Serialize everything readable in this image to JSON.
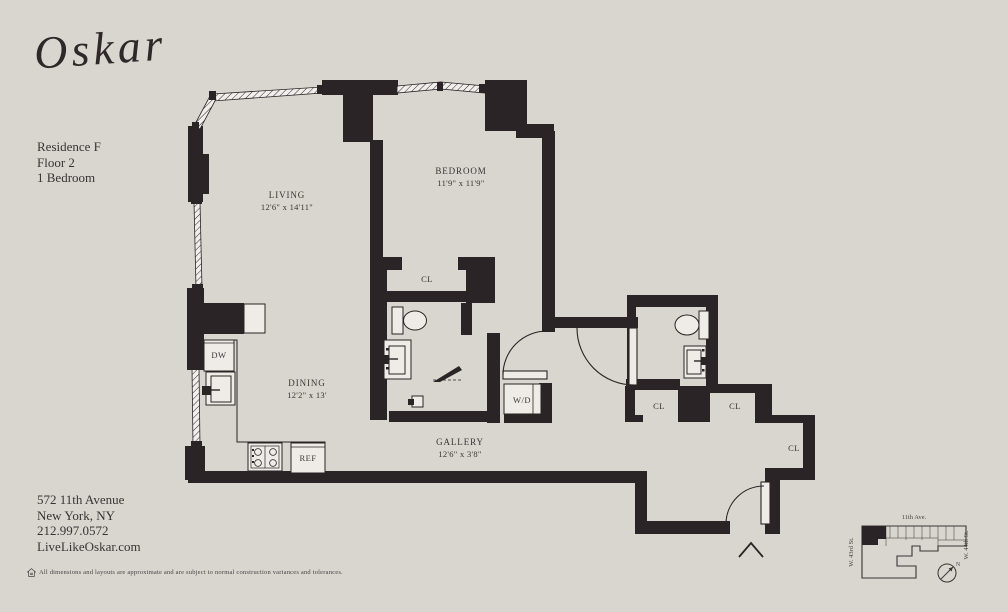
{
  "brand": {
    "logo": "Oskar"
  },
  "unit": {
    "residence": "Residence F",
    "floor": "Floor 2",
    "type": "1 Bedroom"
  },
  "contact": {
    "address": "572 11th Avenue",
    "city": "New York, NY",
    "phone": "212.997.0572",
    "website": "LiveLikeOskar.com"
  },
  "disclaimer": "All dimensions and layouts are approximate and are subject to normal construction variances and tolerances.",
  "rooms": {
    "living": {
      "name": "LIVING",
      "dims": "12'6\" x 14'11\""
    },
    "bedroom": {
      "name": "BEDROOM",
      "dims": "11'9\" x 11'9\""
    },
    "dining": {
      "name": "DINING",
      "dims": "12'2\" x 13'"
    },
    "gallery": {
      "name": "GALLERY",
      "dims": "12'6\" x 3'8\""
    }
  },
  "fixtures": {
    "closet": "CL",
    "dishwasher": "DW",
    "refrigerator": "REF",
    "washer_dryer": "W/D"
  },
  "keyplan": {
    "avenue": "11th Ave.",
    "street_left": "W. 43rd St.",
    "street_right": "W. 44th St.",
    "north": "N"
  },
  "colors": {
    "background": "#d9d5cf",
    "wall": "#2a2426",
    "text": "#3a3335"
  }
}
